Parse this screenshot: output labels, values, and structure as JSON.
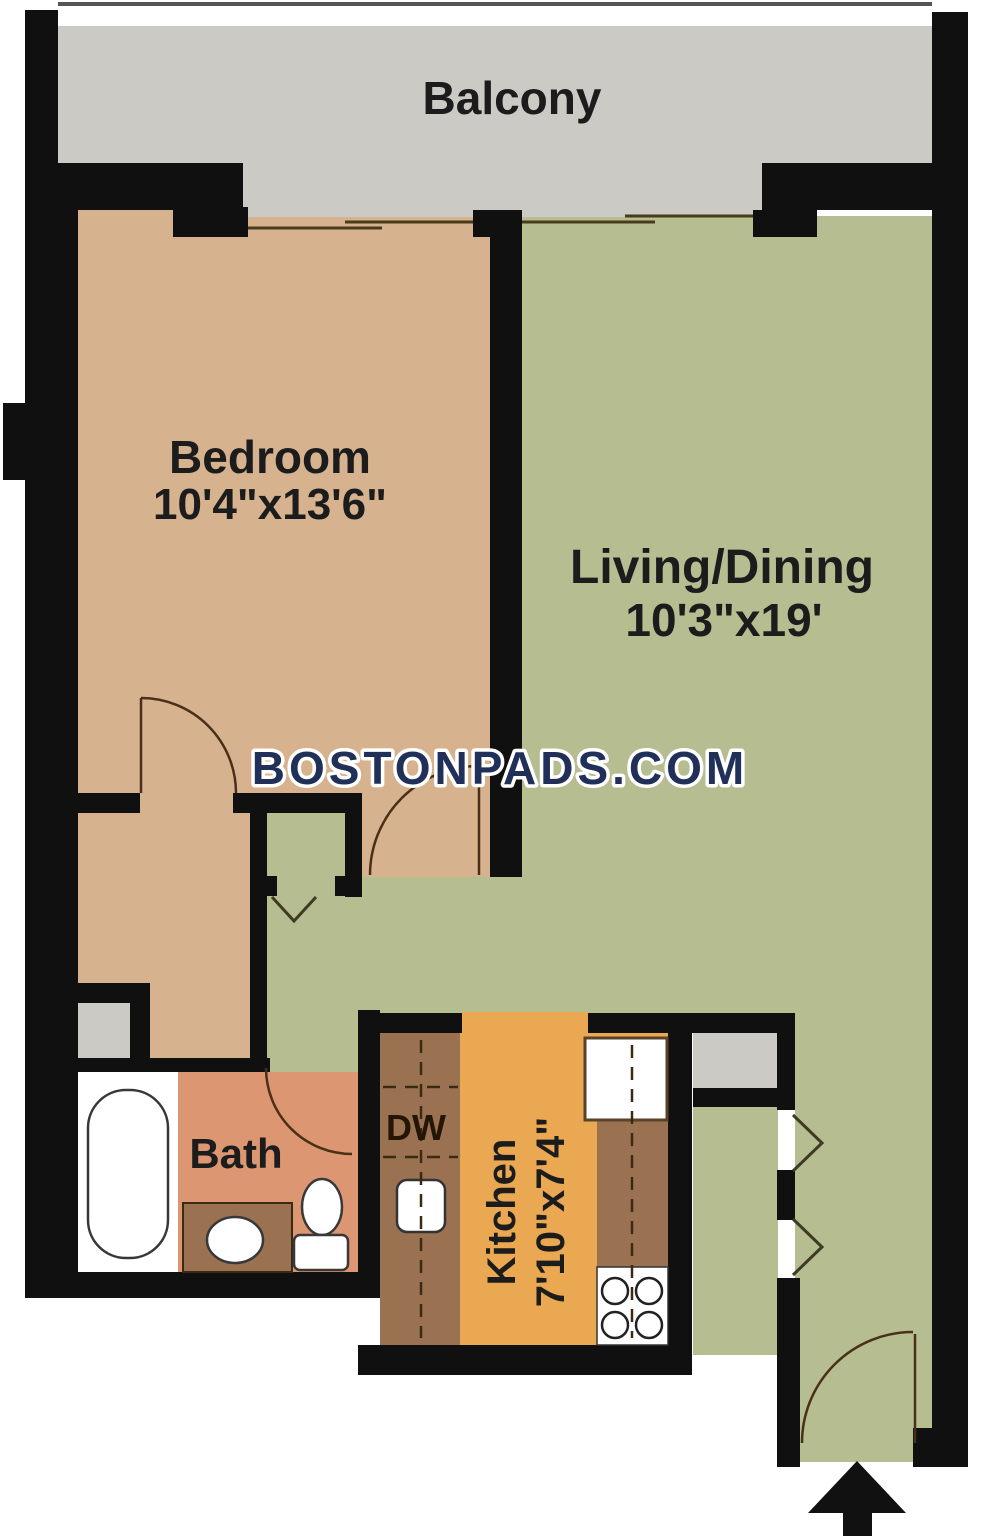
{
  "watermark": "BOSTONPADS.COM",
  "rooms": {
    "balcony": {
      "label": "Balcony"
    },
    "bedroom": {
      "label": "Bedroom",
      "dimensions": "10'4\"x13'6\""
    },
    "living_dining": {
      "label": "Living/Dining",
      "dimensions": "10'3\"x19'"
    },
    "bath": {
      "label": "Bath"
    },
    "kitchen": {
      "label": "Kitchen",
      "dimensions": "7'10\"x7'4\""
    },
    "dishwasher": {
      "label": "DW"
    }
  },
  "icons": {
    "entry_arrow": "black arrow pointing up at unit entry door"
  },
  "colors": {
    "walls": "#101010",
    "balcony_gray": "#cbcac5",
    "bedroom_tan": "#d6b28e",
    "living_green": "#b6bd91",
    "bath_salmon": "#dc9672",
    "kitchen_orange": "#eaa852",
    "counter_brown": "#9b7251",
    "watermark_navy": "#203058"
  }
}
